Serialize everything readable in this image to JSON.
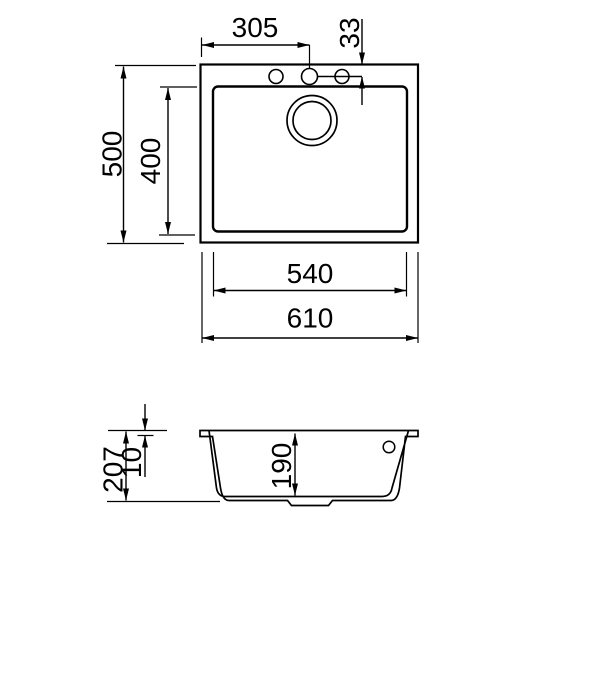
{
  "figure": {
    "background_color": "#ffffff",
    "line_color": "#000000",
    "views": {
      "top_view": {
        "labels": {
          "tap_holes_center_from_left": "305",
          "tap_holes_center_from_top_edge": "33",
          "overall_depth": "500",
          "bowl_inner_depth": "400",
          "bowl_inner_width": "540",
          "overall_width": "610"
        }
      },
      "side_view": {
        "labels": {
          "overall_height": "207",
          "rim_thickness": "10",
          "bowl_depth": "190"
        }
      }
    }
  }
}
